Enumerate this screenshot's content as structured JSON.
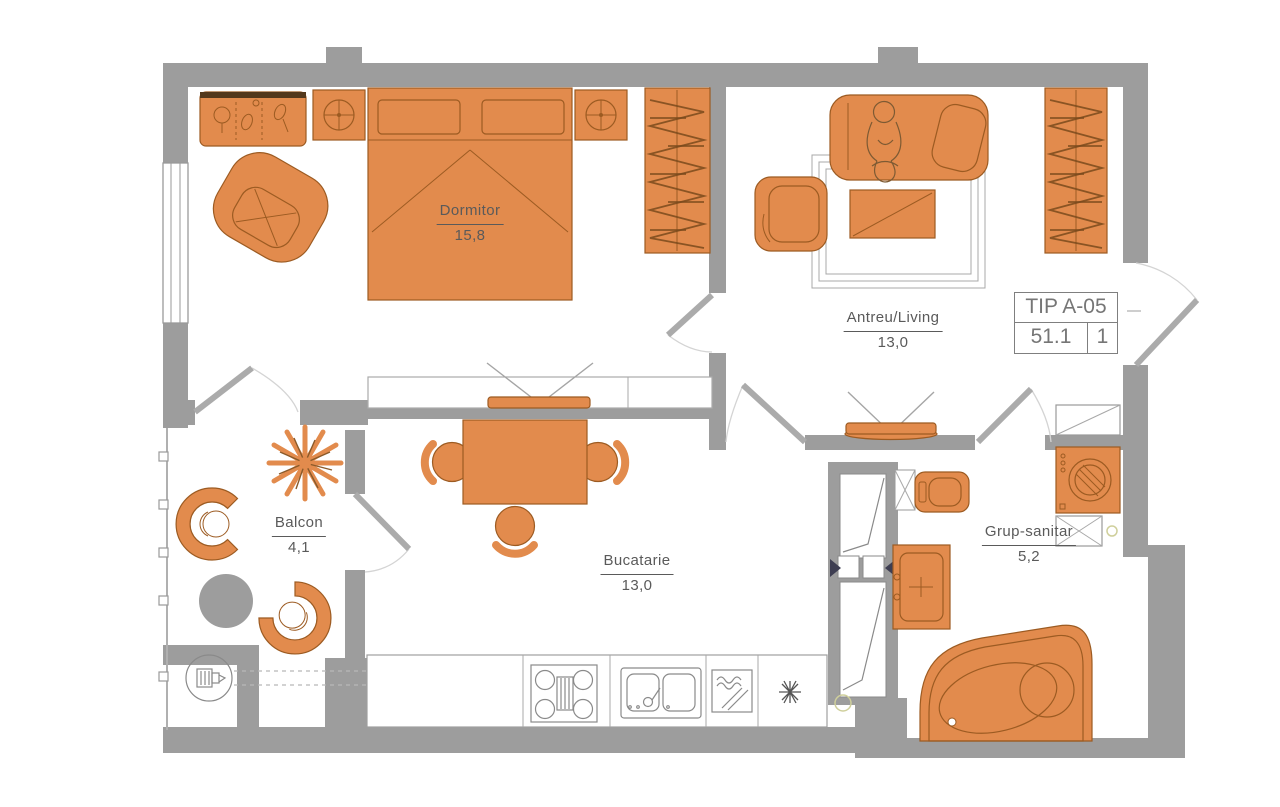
{
  "title_block": {
    "type_label": "TIP A-05",
    "total_area": "51.1",
    "unit_count": "1"
  },
  "rooms": [
    {
      "id": "dormitor",
      "name": "Dormitor",
      "area": "15,8"
    },
    {
      "id": "antreu_living",
      "name": "Antreu/Living",
      "area": "13,0"
    },
    {
      "id": "balcon",
      "name": "Balcon",
      "area": "4,1"
    },
    {
      "id": "bucatarie",
      "name": "Bucatarie",
      "area": "13,0"
    },
    {
      "id": "grup_sanitar",
      "name": "Grup-sanitar",
      "area": "5,2"
    }
  ],
  "colors": {
    "wall": "#9d9d9d",
    "furniture": "#E28B4D",
    "furniture_outline": "#9c5b22",
    "line_art": "#8a8a8a",
    "label_text": "#5a5a5a"
  }
}
